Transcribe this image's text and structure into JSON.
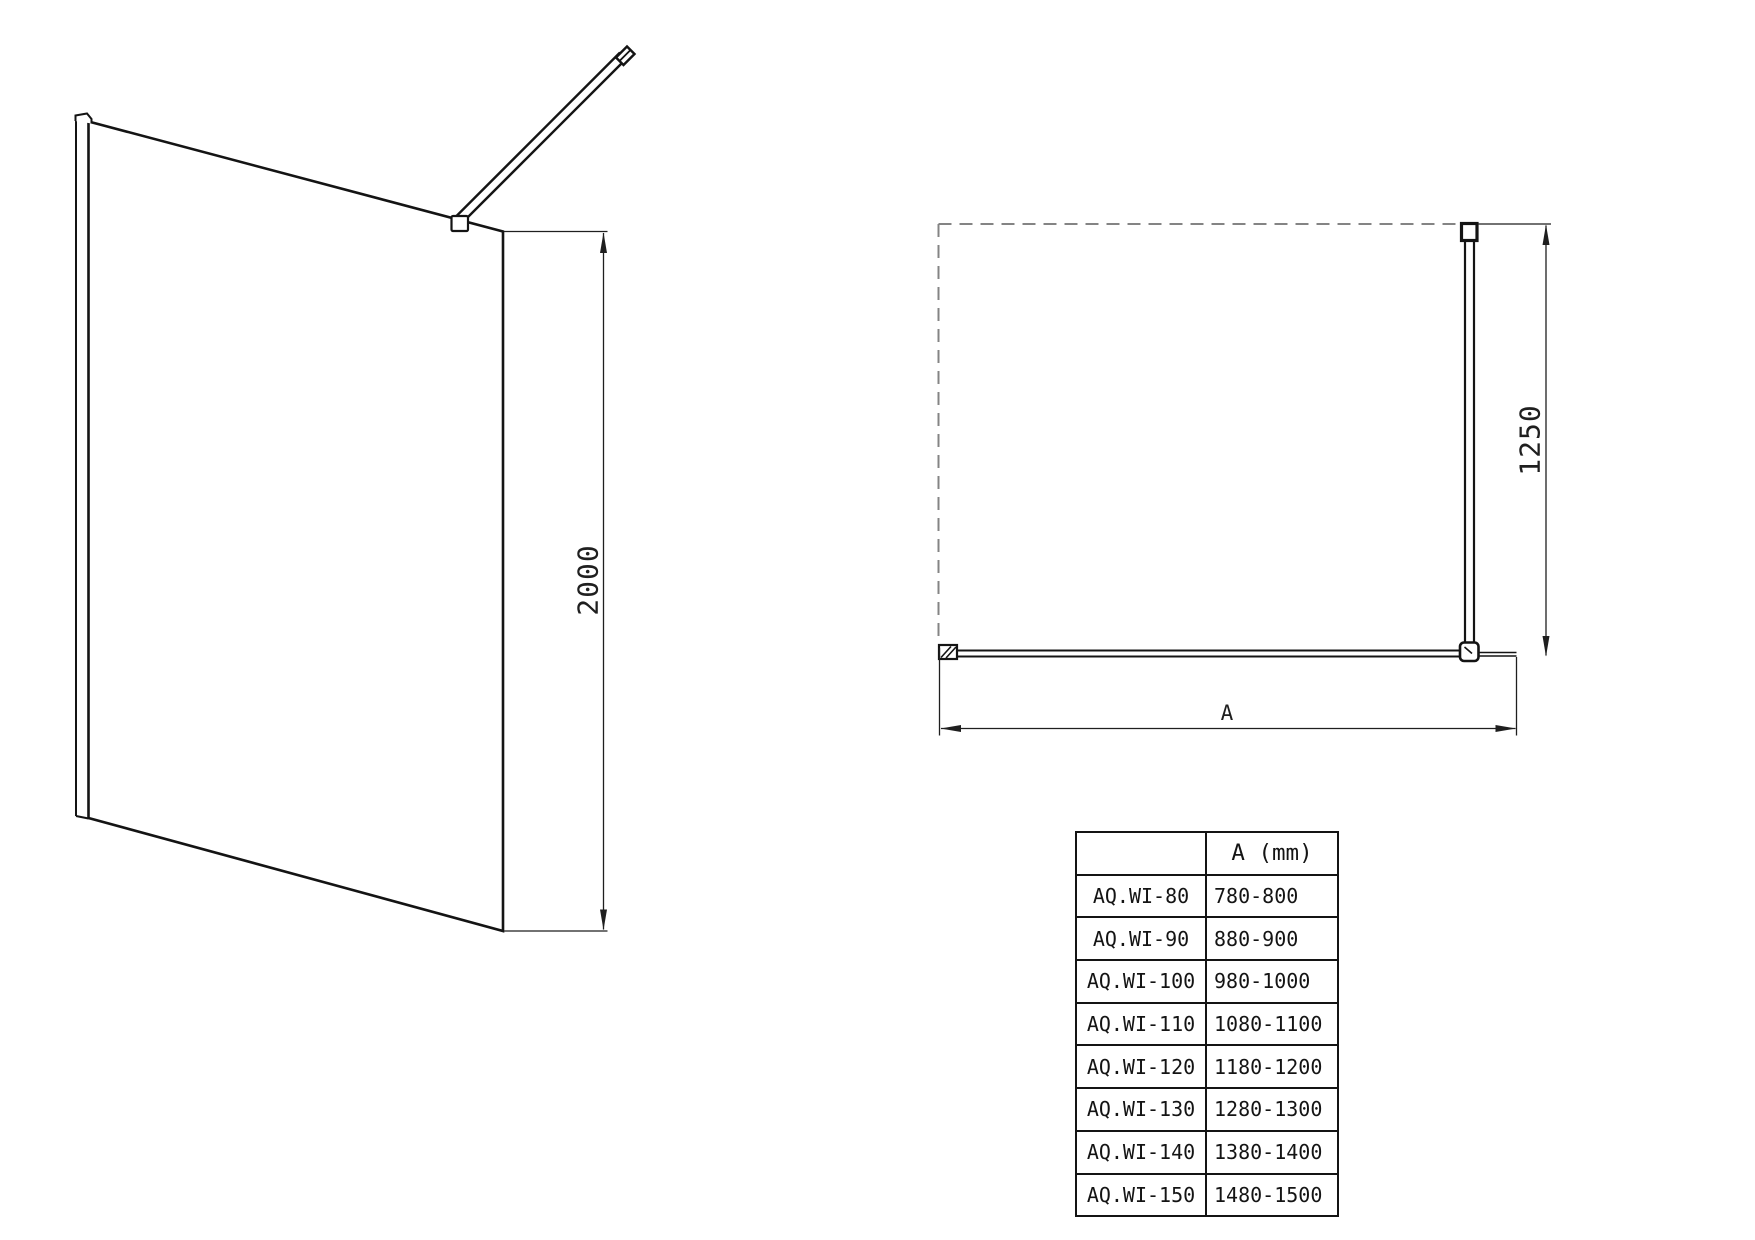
{
  "left_view": {
    "height_label": "2000"
  },
  "plan_view": {
    "depth_label": "1250",
    "width_label": "A"
  },
  "size_table": {
    "header_model": "",
    "header_a": "A (mm)",
    "rows": [
      {
        "model": "AQ.WI-80",
        "range": "780-800"
      },
      {
        "model": "AQ.WI-90",
        "range": "880-900"
      },
      {
        "model": "AQ.WI-100",
        "range": "980-1000"
      },
      {
        "model": "AQ.WI-110",
        "range": "1080-1100"
      },
      {
        "model": "AQ.WI-120",
        "range": "1180-1200"
      },
      {
        "model": "AQ.WI-130",
        "range": "1280-1300"
      },
      {
        "model": "AQ.WI-140",
        "range": "1380-1400"
      },
      {
        "model": "AQ.WI-150",
        "range": "1480-1500"
      }
    ]
  }
}
